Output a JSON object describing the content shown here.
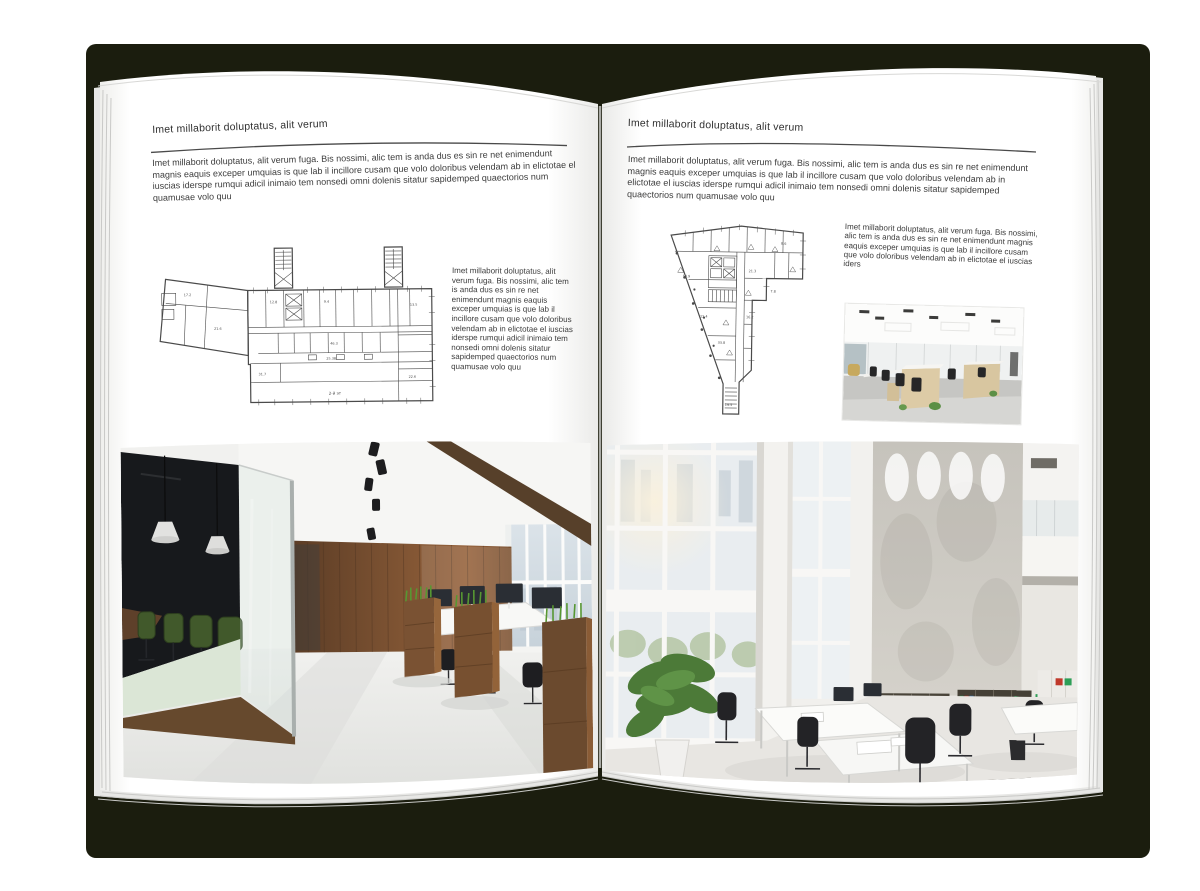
{
  "colors": {
    "cover": "#1b1d0e",
    "page": "#ffffff",
    "body_text": "#3c3c3c",
    "rule": "#4a4a4a",
    "plan_line": "#4a4a4a"
  },
  "left_page": {
    "header": "Imet millaborit doluptatus, alit verum",
    "intro": "Imet millaborit doluptatus, alit verum fuga. Bis nossimi, alic tem is anda dus es sin re net enimendunt magnis eaquis exceper umquias is que lab il incillore cusam que volo doloribus velendam ab in elictotae el iuscias iderspe rumqui adicil inimaio tem nonsedi omni dolenis sitatur sapidemped quaectorios num quamusae volo quu",
    "side_text": "Imet millaborit doluptatus, alit verum fuga. Bis nossimi, alic tem is anda dus es sin re net enimendunt magnis eaquis exceper umquias is que lab il incillore cusam que volo doloribus velendam ab in elictotae el iuscias iderspe rumqui adicil inimaio tem nonsedi omni dolenis sitatur sapidemped quaectorios num quamusae volo quu",
    "floorplan": {
      "alt": "Floor plan of elongated office building with two stair towers and angled left wing",
      "floor_label": "2-й эт",
      "room_labels": [
        "17.2",
        "21.6",
        "12.8",
        "9.4",
        "13.5",
        "46.3",
        "25.38",
        "31.7",
        "22.6"
      ]
    },
    "photo": {
      "alt": "Office interior with glass meeting room, green chairs, wooden wall and planter boxes"
    }
  },
  "right_page": {
    "header": "Imet millaborit doluptatus, alit verum",
    "intro": "Imet millaborit doluptatus, alit verum fuga. Bis nossimi, alic tem is anda dus es sin re net enimendunt magnis eaquis exceper umquias is que lab il incillore cusam que volo doloribus velendam ab in elictotae el iuscias iderspe rumqui adicil inimaio tem nonsedi omni dolenis sitatur sapidemped quaectorios num quamusae volo quu",
    "side_text": "Imet millaborit doluptatus, alit verum fuga. Bis nossimi, alic tem is anda dus es sin re net eni­mendunt magnis eaquis exceper umquias is que lab il incillore cusam que volo doloribus velendam ab in elictotae el iuscias iders",
    "floorplan": {
      "alt": "Floor plan of irregular triangular building with central core and bottom stem",
      "room_labels": [
        "14.9",
        "21.3",
        "8.6",
        "12.4",
        "33.8",
        "16.2",
        "7.8",
        "19.5"
      ]
    },
    "photo_small": {
      "alt": "Open-plan office with rows of light wood desks, black chairs and white ceiling"
    },
    "photo_large": {
      "alt": "Bright double-height office with tall windows, concrete wall, shelving with binders and white desks"
    }
  }
}
